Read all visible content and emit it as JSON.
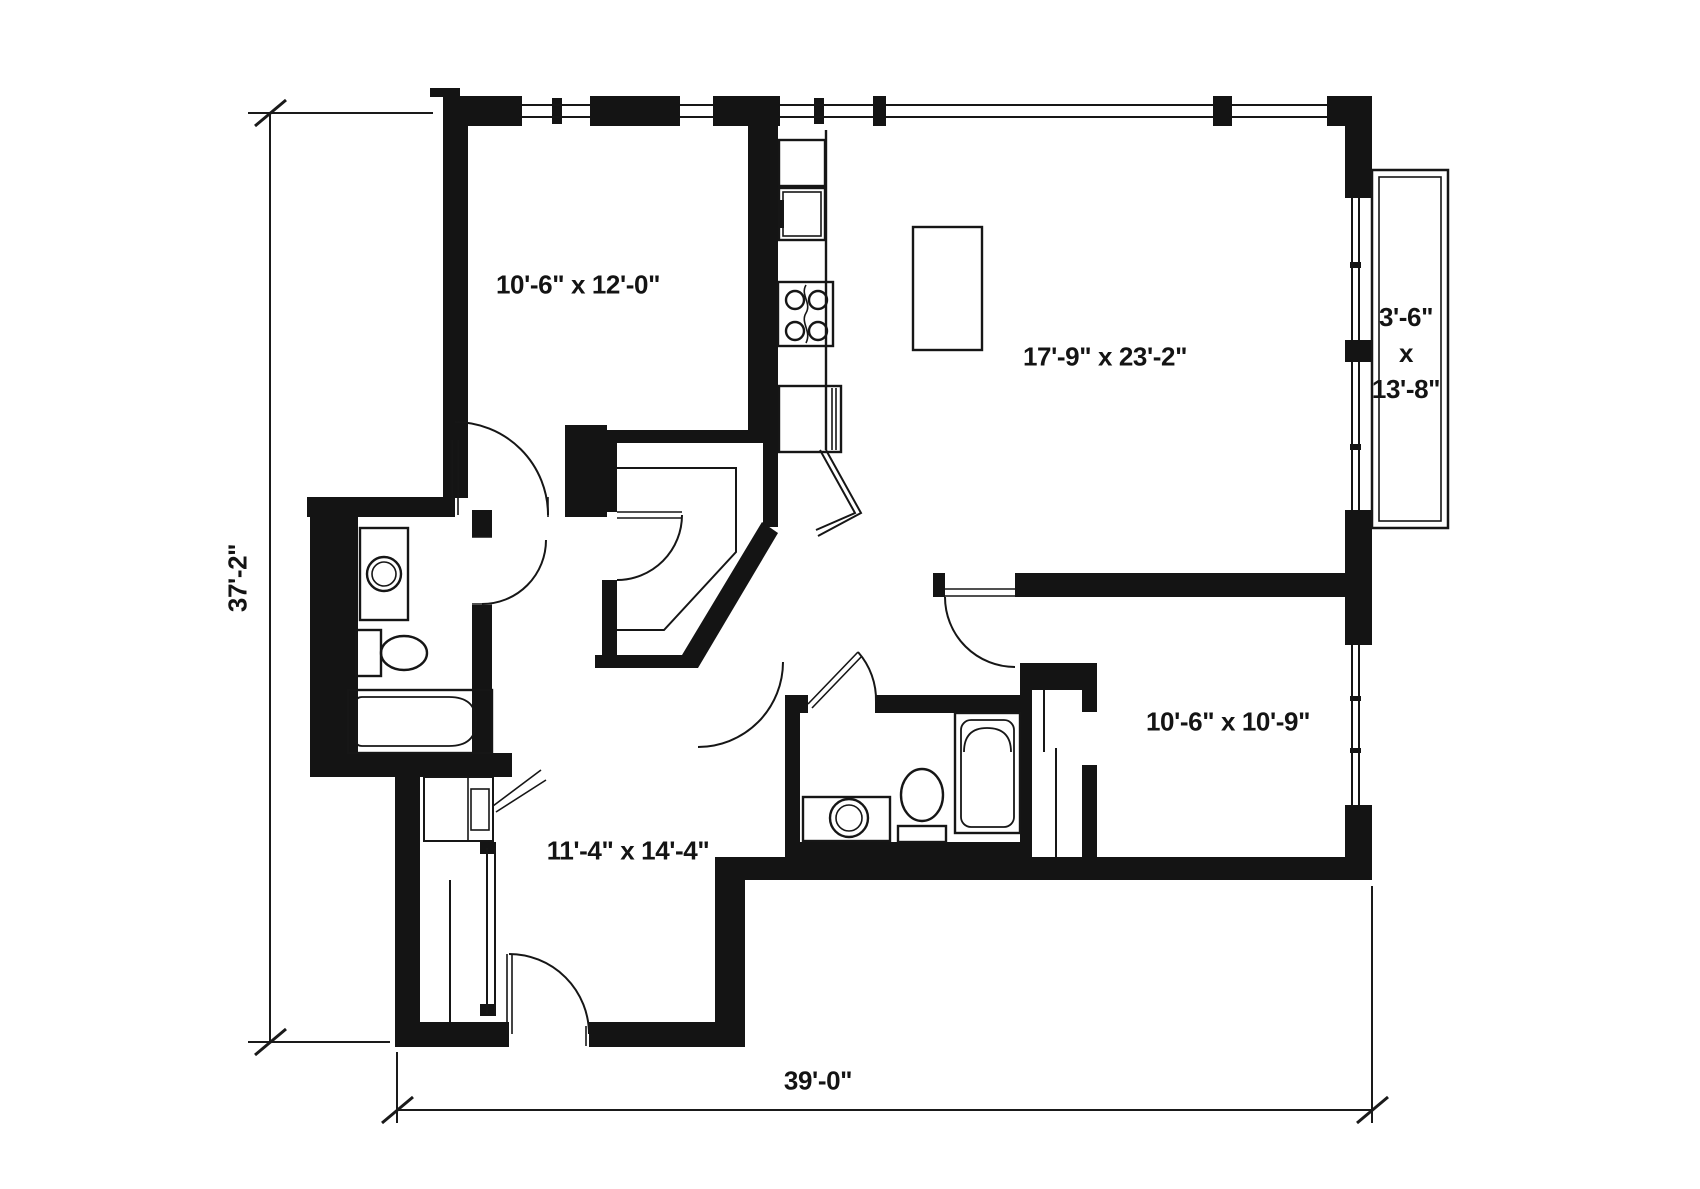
{
  "title": "apartment-floor-plan",
  "labels": {
    "bedroom_top_left": "10'-6\" x 12'-0\"",
    "living_dining": "17'-9\" x 23'-2\"",
    "balcony_width": "3'-6\"",
    "balcony_sep": "x",
    "balcony_length": "13'-8\"",
    "bedroom_bottom_left": "11'-4\" x 14'-4\"",
    "bedroom_bottom_right": "10'-6\" x 10'-9\"",
    "overall_depth": "37'-2\"",
    "overall_width": "39'-0\""
  },
  "colors": {
    "background": "#ffffff",
    "wall": "#141414",
    "line": "#1a1a1a"
  },
  "fixtures": [
    "refrigerator",
    "upper-cabinet",
    "range-4-burner",
    "dishwasher",
    "kitchen-island",
    "walk-in-closet",
    "bathtub-1",
    "toilet-1",
    "vanity-sink-1",
    "bathtub-2",
    "toilet-2",
    "vanity-sink-2",
    "wardrobe",
    "sliding-door-closet-1",
    "sliding-door-closet-2",
    "balcony-sliding-door",
    "windows",
    "swing-doors"
  ]
}
